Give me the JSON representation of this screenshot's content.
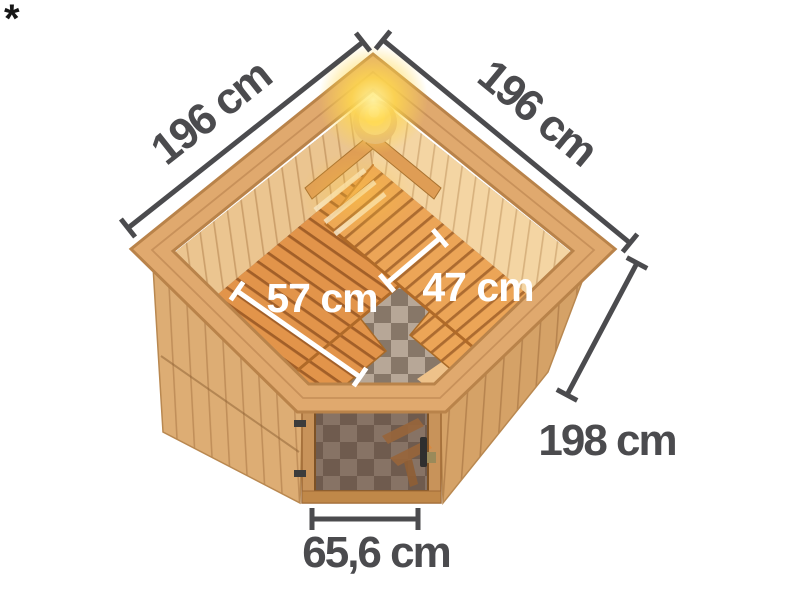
{
  "page": {
    "background": "#ffffff",
    "footnote_marker": "*"
  },
  "illustration": {
    "subject": "Corner sauna seen from above: open ceiling, corner light, two-tier wooden benches, checkered floor, bronze glass door",
    "colors": {
      "wood_rim": "#e0a96e",
      "wood_rim_edge": "#b9834a",
      "wood_wall_interior_left": "#ebc590",
      "wood_wall_interior_right": "#f4d5a3",
      "wood_exterior_left": "#ddad74",
      "wood_exterior_right": "#d5a267",
      "wood_bench": "#e2944a",
      "bench_gap": "#7d4012",
      "floor_tile_light": "#b7a797",
      "floor_tile_dark": "#877768",
      "light_glow": "#ffd84e",
      "dimension_text": "#4b4b4e",
      "inner_dimension_text": "#ffffff"
    }
  },
  "dimensions": {
    "wall_left": "196 cm",
    "wall_right": "196 cm",
    "bench_left_depth": "57 cm",
    "bench_right_depth": "47 cm",
    "wall_height": "198 cm",
    "door_width": "65,6 cm"
  }
}
